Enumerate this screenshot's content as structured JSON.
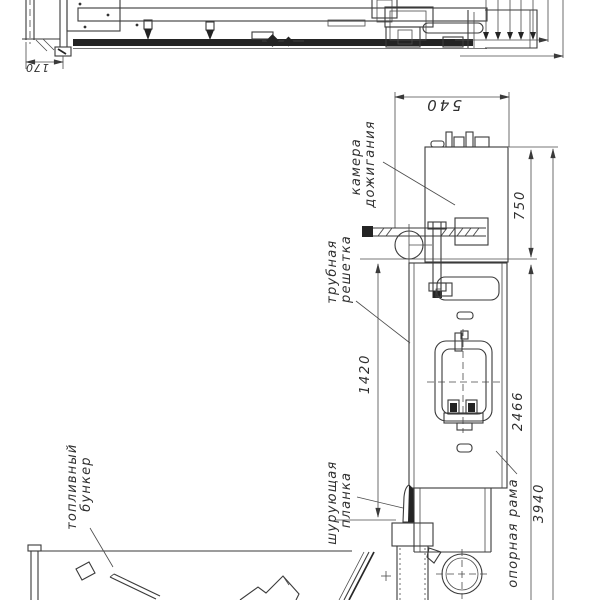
{
  "drawing": {
    "labels": {
      "combustion_chamber": {
        "line1": "камера",
        "line2": "дожигания"
      },
      "tube_grate": {
        "line1": "трубная",
        "line2": "решетка"
      },
      "fuel_bunker": {
        "line1": "топливный",
        "line2": "бункер"
      },
      "stoker_plank": {
        "line1": "шурующая",
        "line2": "планка"
      },
      "support_frame": {
        "label": "опорная рама"
      }
    },
    "dimensions": {
      "d170": "170",
      "d540": "540",
      "d750": "750",
      "d1420": "1420",
      "d2466": "2466",
      "d3940": "3940"
    },
    "colors": {
      "line": "#3a3a3a",
      "dark_fill": "#242424",
      "background": "#ffffff",
      "text": "#303030"
    }
  }
}
